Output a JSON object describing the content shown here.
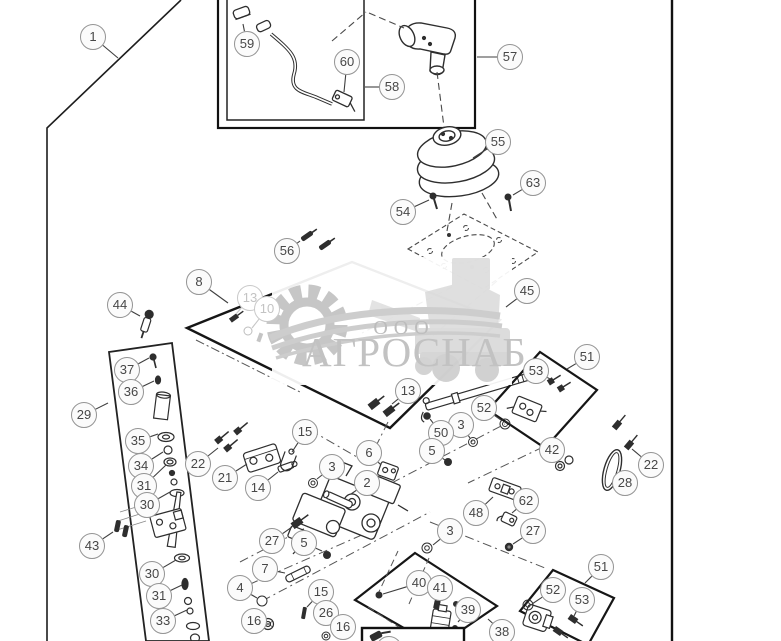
{
  "figure": {
    "type": "exploded-parts-diagram"
  },
  "watermark": {
    "org_prefix": "ООО",
    "org_name": "АГРОСНАБ"
  },
  "colors": {
    "line_art": "#2e2e2e",
    "frame": "#161616",
    "balloon_border": "#949494",
    "balloon_text": "#474747",
    "faded_callout": "#c3c3c3",
    "watermark_gray": "#c6c6c6",
    "background": "#ffffff"
  },
  "callouts": [
    {
      "label": "1",
      "x": 93,
      "y": 37,
      "tx": 118,
      "ty": 58
    },
    {
      "label": "59",
      "x": 247,
      "y": 44,
      "tx": 243,
      "ty": 24
    },
    {
      "label": "60",
      "x": 347,
      "y": 62,
      "tx": 344,
      "ty": 92
    },
    {
      "label": "58",
      "x": 392,
      "y": 87,
      "tx": 365,
      "ty": 87
    },
    {
      "label": "57",
      "x": 510,
      "y": 57,
      "tx": 477,
      "ty": 57
    },
    {
      "label": "55",
      "x": 498,
      "y": 142,
      "tx": 473,
      "ty": 158
    },
    {
      "label": "63",
      "x": 533,
      "y": 183,
      "tx": 513,
      "ty": 195
    },
    {
      "label": "54",
      "x": 403,
      "y": 212,
      "tx": 429,
      "ty": 200
    },
    {
      "label": "45",
      "x": 527,
      "y": 291,
      "tx": 506,
      "ty": 307
    },
    {
      "label": "56",
      "x": 287,
      "y": 251,
      "tx": 300,
      "ty": 241
    },
    {
      "label": "8",
      "x": 199,
      "y": 282,
      "tx": 228,
      "ty": 303
    },
    {
      "label": "13",
      "x": 250,
      "y": 298,
      "tx": 236,
      "ty": 314,
      "faded": true
    },
    {
      "label": "10",
      "x": 267,
      "y": 309,
      "tx": 252,
      "ty": 328,
      "faded": true
    },
    {
      "label": "44",
      "x": 120,
      "y": 305,
      "tx": 140,
      "ty": 316
    },
    {
      "label": "29",
      "x": 84,
      "y": 415,
      "tx": 108,
      "ty": 403
    },
    {
      "label": "37",
      "x": 127,
      "y": 370,
      "tx": 149,
      "ty": 358
    },
    {
      "label": "36",
      "x": 131,
      "y": 392,
      "tx": 154,
      "ty": 381
    },
    {
      "label": "35",
      "x": 138,
      "y": 441,
      "tx": 158,
      "ty": 434
    },
    {
      "label": "34",
      "x": 141,
      "y": 466,
      "tx": 163,
      "ty": 452
    },
    {
      "label": "31",
      "x": 144,
      "y": 486,
      "tx": 166,
      "ty": 465
    },
    {
      "label": "30",
      "x": 147,
      "y": 505,
      "tx": 170,
      "ty": 492
    },
    {
      "label": "43",
      "x": 92,
      "y": 546,
      "tx": 113,
      "ty": 532
    },
    {
      "label": "30",
      "x": 152,
      "y": 574,
      "tx": 176,
      "ty": 560
    },
    {
      "label": "31",
      "x": 159,
      "y": 596,
      "tx": 182,
      "ty": 585
    },
    {
      "label": "33",
      "x": 163,
      "y": 621,
      "tx": 187,
      "ty": 610
    },
    {
      "label": "22",
      "x": 198,
      "y": 464,
      "tx": 218,
      "ty": 448
    },
    {
      "label": "21",
      "x": 225,
      "y": 478,
      "tx": 247,
      "ty": 464
    },
    {
      "label": "14",
      "x": 258,
      "y": 488,
      "tx": 278,
      "ty": 472
    },
    {
      "label": "13",
      "x": 408,
      "y": 391,
      "tx": 392,
      "ty": 404
    },
    {
      "label": "52",
      "x": 484,
      "y": 408,
      "tx": 501,
      "ty": 420
    },
    {
      "label": "3",
      "x": 461,
      "y": 425,
      "tx": 470,
      "ty": 438
    },
    {
      "label": "50",
      "x": 441,
      "y": 433,
      "tx": 430,
      "ty": 419
    },
    {
      "label": "5",
      "x": 432,
      "y": 451,
      "tx": 445,
      "ty": 460
    },
    {
      "label": "6",
      "x": 369,
      "y": 453,
      "tx": 381,
      "ty": 465
    },
    {
      "label": "15",
      "x": 305,
      "y": 432,
      "tx": 292,
      "ty": 452
    },
    {
      "label": "3",
      "x": 332,
      "y": 467,
      "tx": 317,
      "ty": 479
    },
    {
      "label": "2",
      "x": 367,
      "y": 483,
      "tx": 351,
      "ty": 494
    },
    {
      "label": "48",
      "x": 476,
      "y": 513,
      "tx": 493,
      "ty": 497
    },
    {
      "label": "62",
      "x": 526,
      "y": 501,
      "tx": 512,
      "ty": 513
    },
    {
      "label": "27",
      "x": 533,
      "y": 531,
      "tx": 513,
      "ty": 544
    },
    {
      "label": "3",
      "x": 450,
      "y": 531,
      "tx": 433,
      "ty": 545
    },
    {
      "label": "27",
      "x": 272,
      "y": 541,
      "tx": 292,
      "ty": 527
    },
    {
      "label": "5",
      "x": 304,
      "y": 543,
      "tx": 322,
      "ty": 551
    },
    {
      "label": "42",
      "x": 552,
      "y": 450,
      "tx": 559,
      "ty": 462
    },
    {
      "label": "22",
      "x": 651,
      "y": 465,
      "tx": 632,
      "ty": 449
    },
    {
      "label": "28",
      "x": 625,
      "y": 483,
      "tx": 614,
      "ty": 473
    },
    {
      "label": "51",
      "x": 587,
      "y": 357,
      "tx": 567,
      "ty": 369
    },
    {
      "label": "53",
      "x": 536,
      "y": 371,
      "tx": 550,
      "ty": 379
    },
    {
      "label": "7",
      "x": 265,
      "y": 569,
      "tx": 285,
      "ty": 573
    },
    {
      "label": "4",
      "x": 240,
      "y": 588,
      "tx": 257,
      "ty": 598
    },
    {
      "label": "15",
      "x": 321,
      "y": 592,
      "tx": 307,
      "ty": 607
    },
    {
      "label": "26",
      "x": 326,
      "y": 613
    },
    {
      "label": "16",
      "x": 254,
      "y": 621
    },
    {
      "label": "16",
      "x": 343,
      "y": 627,
      "tx": 330,
      "ty": 634
    },
    {
      "label": "40",
      "x": 419,
      "y": 583,
      "tx": 383,
      "ty": 594
    },
    {
      "label": "41",
      "x": 440,
      "y": 588,
      "tx": 437,
      "ty": 601
    },
    {
      "label": "39",
      "x": 468,
      "y": 610,
      "tx": 458,
      "ty": 622
    },
    {
      "label": "38",
      "x": 502,
      "y": 632,
      "tx": 488,
      "ty": 619
    },
    {
      "label": "51",
      "x": 601,
      "y": 567,
      "tx": 585,
      "ty": 583
    },
    {
      "label": "52",
      "x": 553,
      "y": 590,
      "tx": 532,
      "ty": 604
    },
    {
      "label": "53",
      "x": 582,
      "y": 600,
      "tx": 574,
      "ty": 616
    },
    {
      "label": "",
      "x": 389,
      "y": 649
    }
  ]
}
